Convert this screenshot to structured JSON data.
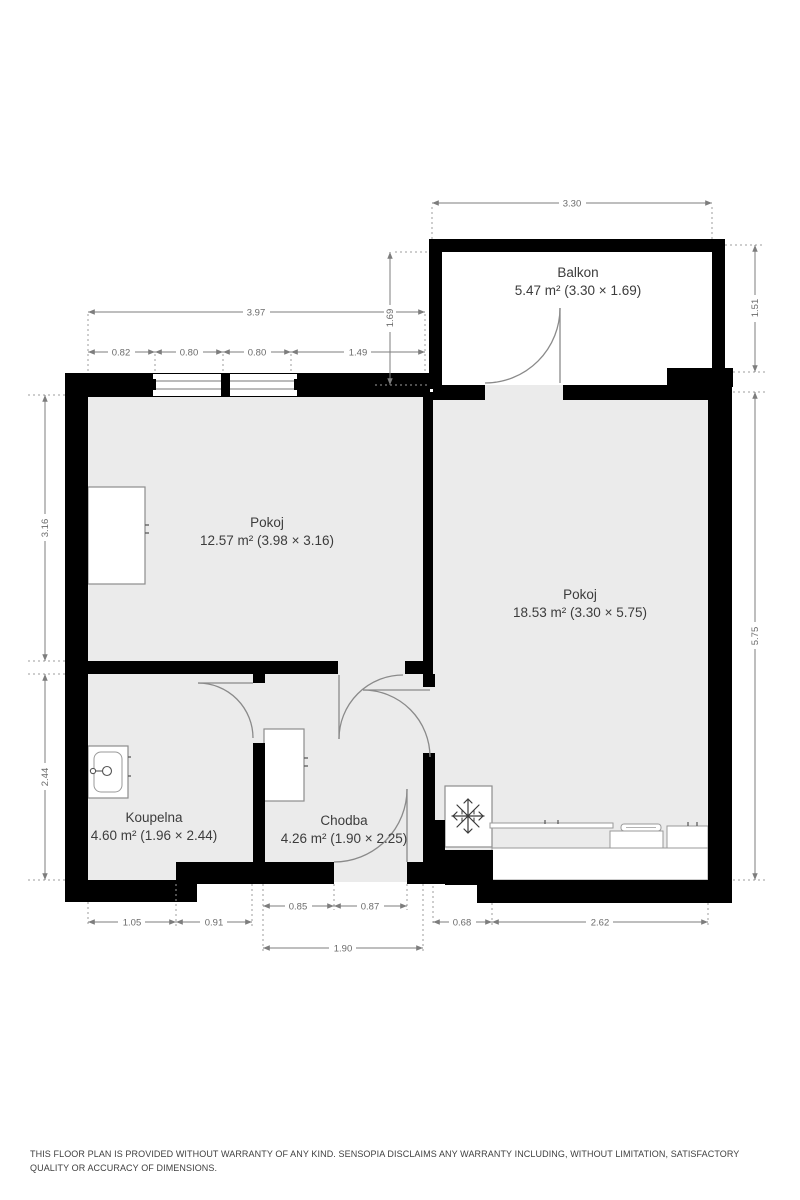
{
  "plan": {
    "rooms": [
      {
        "name": "Balkon",
        "area": "5.47 m² (3.30 × 1.69)"
      },
      {
        "name": "Pokoj",
        "area": "12.57 m² (3.98 × 3.16)"
      },
      {
        "name": "Pokoj",
        "area": "18.53 m² (3.30 × 5.75)"
      },
      {
        "name": "Koupelna",
        "area": "4.60 m² (1.96 × 2.44)"
      },
      {
        "name": "Chodba",
        "area": "4.26 m² (1.90 × 2.25)"
      }
    ],
    "dims": {
      "balkon_width": "3.30",
      "balkon_depth": "1.69",
      "balkon_depth_right": "1.51",
      "pokoj1_width": "3.97",
      "pokoj1_seg1": "0.82",
      "pokoj1_seg2": "0.80",
      "pokoj1_seg3": "0.80",
      "pokoj1_seg4": "1.49",
      "pokoj1_height": "3.16",
      "koupelna_height": "2.44",
      "pokoj2_height": "5.75",
      "chodba_seg1": "0.85",
      "chodba_seg2": "0.87",
      "koupelna_seg1": "1.05",
      "koupelna_seg2": "0.91",
      "kitchen_offset": "0.68",
      "kitchen_width": "2.62",
      "chodba_width": "1.90"
    },
    "icons": [
      "snowflake-icon",
      "sink-icon",
      "stove-icon",
      "window-icon",
      "door-arc-icon"
    ],
    "colors": {
      "wall": "#000000",
      "floor": "#ebebeb",
      "dimension": "#6b6b6b",
      "label": "#3c3c3c",
      "furniture_border": "#8d8d8d"
    },
    "disclaimer": "THIS FLOOR PLAN IS PROVIDED WITHOUT WARRANTY OF ANY KIND. SENSOPIA DISCLAIMS ANY WARRANTY INCLUDING, WITHOUT LIMITATION, SATISFACTORY QUALITY OR ACCURACY OF DIMENSIONS."
  }
}
